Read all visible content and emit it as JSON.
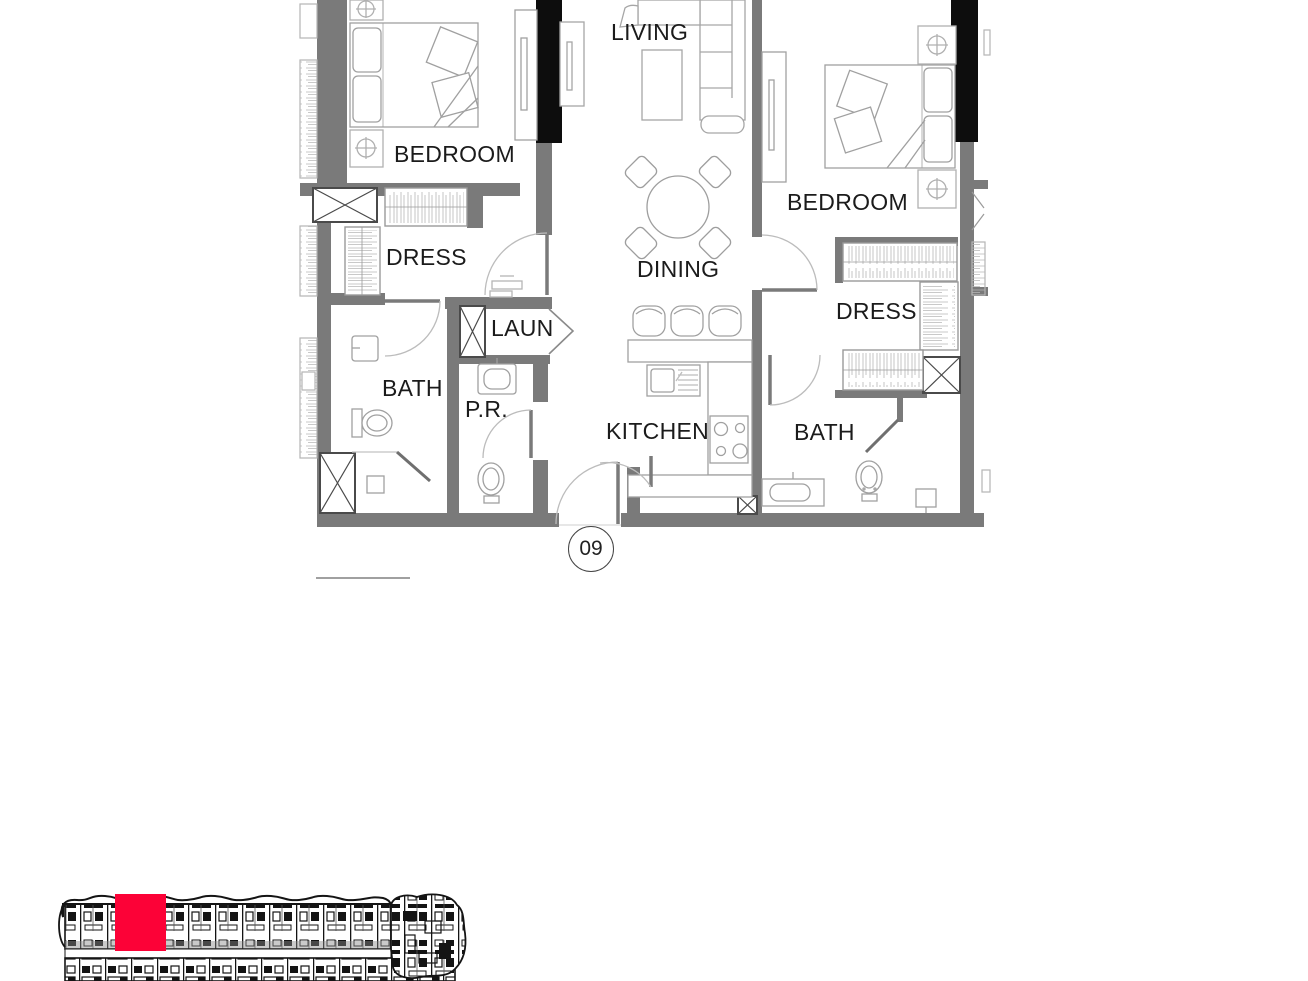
{
  "plan": {
    "unit_number": "09",
    "rooms": {
      "living": "LIVING",
      "bedroom_left": "BEDROOM",
      "dress_left": "DRESS",
      "bath_left": "BATH",
      "laundry": "LAUN",
      "powder_room": "P.R.",
      "dining": "DINING",
      "kitchen": "KITCHEN",
      "bedroom_right": "BEDROOM",
      "dress_right": "DRESS",
      "bath_right": "BATH"
    }
  },
  "minimap": {
    "highlight_color": "#FC0237"
  },
  "colors": {
    "wall": "#7a7a7a",
    "column": "#0d0d0d",
    "furniture_line": "#a6a6a6"
  }
}
